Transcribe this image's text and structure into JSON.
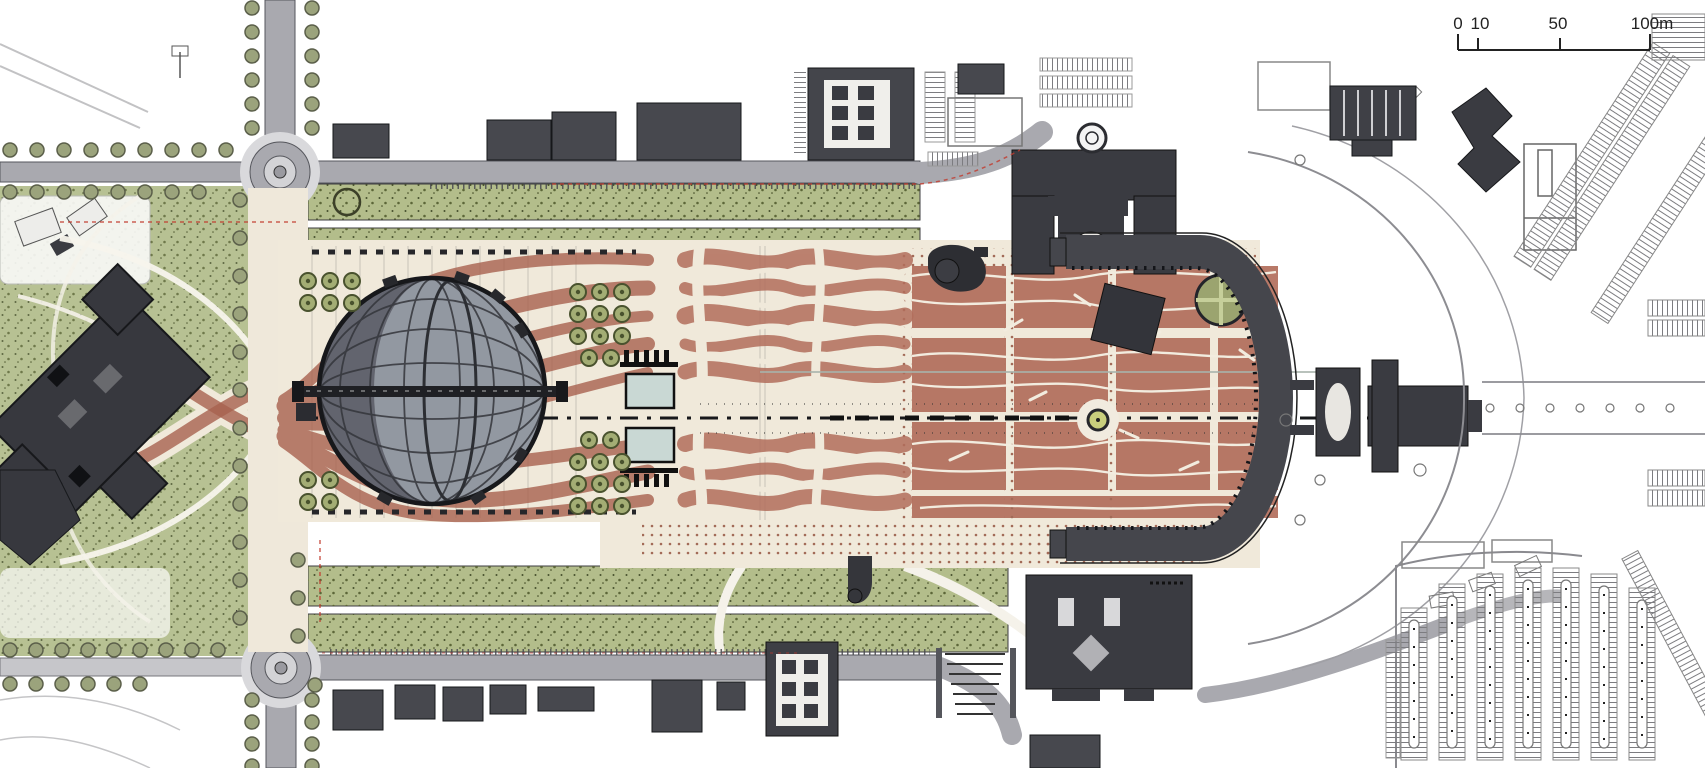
{
  "page": {
    "type": "architectural-masterplan-site-plan",
    "view": "top-down plan of a monumental axial plaza with domed pavilion, colonnade, parkland, roads and parking"
  },
  "scale_bar": {
    "labels": {
      "zero": "0",
      "ten": "10",
      "fifty": "50",
      "hundred": "100m"
    }
  },
  "palette": {
    "plaza_cream": "#f0e9da",
    "path_red": "#a8614f",
    "panel_red": "#b26e5c",
    "lawn_green": "#b3bd8b",
    "tree_olive": "#a3ad74",
    "building_dark": "#3a3b41",
    "colonnade_dark": "#45464c",
    "road_gray": "#a9a9af",
    "water_blue": "#c9d8d4",
    "ink": "#1c1d20"
  },
  "features": {
    "west_park": "landscaped park with curved paths",
    "west_museum_building": "large dark building rotated 45 degrees",
    "north_roundabout": "traffic circle, north-west",
    "south_roundabout": "traffic circle, south-west",
    "promenade": "tree-lined pedestrian promenade between roundabouts",
    "north_lawn_band": "double lawn strip along north edge of plaza",
    "south_lawn_band": "double lawn strip along south edge of plaza",
    "great_plaza": "central cream plaza with woven red paving ribbons",
    "domed_pavilion": "circular grid-shell dome over amphitheatre",
    "reflecting_pools": "two square water pools on axis",
    "tree_bosques": "gridded tree clusters",
    "axial_centerline": "dash-dot section axis line",
    "north_monument": "symmetric dark civic building, north side",
    "south_monument": "symmetric dark civic building, south side",
    "east_colonnade": "C-shaped colonnade closing the plaza east end",
    "axial_fountain": "small circular fountain on axis",
    "tilted_pavilion": "small rotated dark pavilion",
    "chapel": "cross-shaped building on east axis",
    "east_ring_road": "curved ring road around east end",
    "southeast_parking": "large surface parking lot with planted islands",
    "northeast_parking": "angled parking rows",
    "scale_bar": "graphic bar scale 0-100 metres"
  }
}
